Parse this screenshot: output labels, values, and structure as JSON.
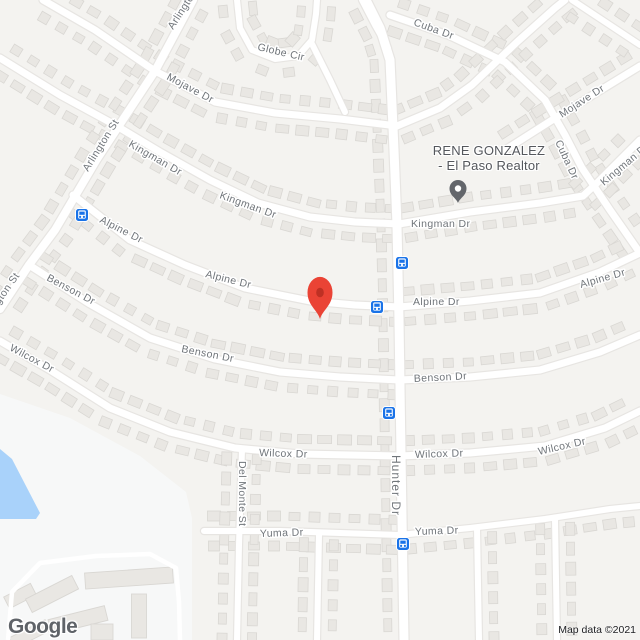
{
  "map": {
    "width": 640,
    "height": 640
  },
  "attribution": "Map data ©2021",
  "logo": "Google",
  "poi": {
    "line1": "RENE GONZALEZ",
    "line2": "- El Paso Realtor",
    "label_cx": 489,
    "pin": {
      "x": 458,
      "tip_y": 203
    }
  },
  "marker": {
    "x": 320,
    "tip_y": 319
  },
  "bus_stops": [
    {
      "x": 82,
      "y": 215
    },
    {
      "x": 402,
      "y": 263
    },
    {
      "x": 377,
      "y": 307
    },
    {
      "x": 389,
      "y": 413
    },
    {
      "x": 403,
      "y": 544
    }
  ],
  "labels": [
    {
      "t": "Arlington St",
      "x": 173,
      "y": 30,
      "r": -57
    },
    {
      "t": "Arlington St",
      "x": 88,
      "y": 172,
      "r": -58
    },
    {
      "t": "Arlington St",
      "x": -14,
      "y": 324,
      "r": -55
    },
    {
      "t": "Mojave Dr",
      "x": 166,
      "y": 79,
      "r": 28
    },
    {
      "t": "Globe Cir",
      "x": 257,
      "y": 50,
      "r": 13
    },
    {
      "t": "Kingman Dr",
      "x": 128,
      "y": 146,
      "r": 30
    },
    {
      "t": "Kingman Dr",
      "x": 219,
      "y": 198,
      "r": 20
    },
    {
      "t": "Alpine Dr",
      "x": 99,
      "y": 222,
      "r": 27
    },
    {
      "t": "Alpine Dr",
      "x": 205,
      "y": 277,
      "r": 14
    },
    {
      "t": "Benson Dr",
      "x": 46,
      "y": 280,
      "r": 28
    },
    {
      "t": "Benson Dr",
      "x": 181,
      "y": 352,
      "r": 11
    },
    {
      "t": "Wilcox Dr",
      "x": 9,
      "y": 350,
      "r": 28
    },
    {
      "t": "Wilcox Dr",
      "x": 259,
      "y": 456,
      "r": 2
    },
    {
      "t": "Cuba Dr",
      "x": 413,
      "y": 25,
      "r": 20
    },
    {
      "t": "Cuba Dr",
      "x": 555,
      "y": 142,
      "r": 65
    },
    {
      "t": "Mojave Dr",
      "x": 562,
      "y": 118,
      "r": -33
    },
    {
      "t": "Kingman Dr",
      "x": 604,
      "y": 186,
      "r": -40
    },
    {
      "t": "Kingman Dr",
      "x": 411,
      "y": 227,
      "r": 0
    },
    {
      "t": "Alpine Dr",
      "x": 413,
      "y": 305,
      "r": 0
    },
    {
      "t": "Alpine Dr",
      "x": 581,
      "y": 288,
      "r": -16
    },
    {
      "t": "Benson Dr",
      "x": 414,
      "y": 382,
      "r": -3
    },
    {
      "t": "Wilcox Dr",
      "x": 415,
      "y": 458,
      "r": -2
    },
    {
      "t": "Wilcox Dr",
      "x": 539,
      "y": 455,
      "r": -13
    },
    {
      "t": "Yuma Dr",
      "x": 260,
      "y": 537,
      "r": -2
    },
    {
      "t": "Yuma Dr",
      "x": 415,
      "y": 535,
      "r": -2
    },
    {
      "t": "Hunter Dr",
      "x": 392,
      "y": 455,
      "r": 90,
      "s": 12,
      "ls": 1
    },
    {
      "t": "Del Monte St",
      "x": 239,
      "y": 461,
      "r": 90
    }
  ],
  "roads": [
    {
      "name": "hunter-dr",
      "pts": [
        [
          366,
          0
        ],
        [
          380,
          28
        ],
        [
          390,
          60
        ],
        [
          394,
          150
        ],
        [
          397,
          225
        ],
        [
          399,
          320
        ],
        [
          401,
          455
        ],
        [
          404,
          640
        ]
      ],
      "w": 9,
      "houses": true
    },
    {
      "name": "cuba-dr",
      "pts": [
        [
          390,
          15
        ],
        [
          448,
          35
        ],
        [
          505,
          62
        ],
        [
          545,
          100
        ],
        [
          565,
          135
        ],
        [
          582,
          168
        ],
        [
          610,
          210
        ],
        [
          640,
          253
        ]
      ],
      "w": 7,
      "houses": true
    },
    {
      "name": "mojave-dr-w",
      "pts": [
        [
          43,
          0
        ],
        [
          95,
          30
        ],
        [
          155,
          71
        ],
        [
          215,
          102
        ],
        [
          275,
          113
        ],
        [
          340,
          119
        ],
        [
          397,
          126
        ],
        [
          440,
          108
        ],
        [
          472,
          85
        ],
        [
          517,
          42
        ],
        [
          555,
          8
        ],
        [
          565,
          0
        ]
      ],
      "w": 7,
      "houses": true
    },
    {
      "name": "mojave-dr-ne",
      "pts": [
        [
          505,
          150
        ],
        [
          560,
          115
        ],
        [
          640,
          66
        ]
      ],
      "w": 7,
      "houses": true
    },
    {
      "name": "kingman-dr-e",
      "pts": [
        [
          399,
          224
        ],
        [
          470,
          212
        ],
        [
          540,
          203
        ],
        [
          583,
          196
        ],
        [
          598,
          182
        ],
        [
          640,
          140
        ]
      ],
      "w": 7,
      "houses": true
    },
    {
      "name": "kingman-dr-w",
      "pts": [
        [
          0,
          58
        ],
        [
          60,
          95
        ],
        [
          115,
          125
        ],
        [
          160,
          152
        ],
        [
          210,
          180
        ],
        [
          258,
          203
        ],
        [
          310,
          217
        ],
        [
          355,
          222
        ],
        [
          399,
          224
        ]
      ],
      "w": 7,
      "houses": true
    },
    {
      "name": "arlington-st",
      "pts": [
        [
          193,
          0
        ],
        [
          155,
          71
        ],
        [
          124,
          118
        ],
        [
          97,
          159
        ],
        [
          55,
          230
        ],
        [
          29,
          265
        ],
        [
          0,
          309
        ]
      ],
      "w": 8,
      "houses": true
    },
    {
      "name": "alpine-dr-w",
      "pts": [
        [
          73,
          195
        ],
        [
          130,
          240
        ],
        [
          185,
          265
        ],
        [
          245,
          288
        ],
        [
          310,
          301
        ],
        [
          355,
          305
        ],
        [
          399,
          307
        ]
      ],
      "w": 7,
      "houses": true
    },
    {
      "name": "alpine-dr-e",
      "pts": [
        [
          399,
          307
        ],
        [
          470,
          301
        ],
        [
          540,
          293
        ],
        [
          600,
          272
        ],
        [
          640,
          253
        ]
      ],
      "w": 7,
      "houses": true
    },
    {
      "name": "benson-dr-w",
      "pts": [
        [
          29,
          265
        ],
        [
          90,
          304
        ],
        [
          150,
          338
        ],
        [
          215,
          359
        ],
        [
          280,
          372
        ],
        [
          340,
          377
        ],
        [
          399,
          380
        ]
      ],
      "w": 7,
      "houses": true
    },
    {
      "name": "benson-dr-e",
      "pts": [
        [
          399,
          380
        ],
        [
          470,
          377
        ],
        [
          540,
          370
        ],
        [
          600,
          352
        ],
        [
          640,
          335
        ]
      ],
      "w": 7,
      "houses": true
    },
    {
      "name": "wilcox-dr-w",
      "pts": [
        [
          0,
          341
        ],
        [
          50,
          370
        ],
        [
          110,
          408
        ],
        [
          170,
          432
        ],
        [
          235,
          448
        ],
        [
          300,
          454
        ],
        [
          399,
          456
        ]
      ],
      "w": 7,
      "houses": true
    },
    {
      "name": "wilcox-dr-e",
      "pts": [
        [
          399,
          456
        ],
        [
          470,
          453
        ],
        [
          545,
          446
        ],
        [
          605,
          428
        ],
        [
          640,
          411
        ]
      ],
      "w": 7,
      "houses": true
    },
    {
      "name": "yuma-dr-w",
      "pts": [
        [
          204,
          531
        ],
        [
          280,
          531
        ],
        [
          340,
          533
        ],
        [
          399,
          535
        ]
      ],
      "w": 6,
      "houses": true
    },
    {
      "name": "yuma-dr-e",
      "pts": [
        [
          399,
          535
        ],
        [
          470,
          528
        ],
        [
          545,
          519
        ],
        [
          610,
          509
        ],
        [
          640,
          506
        ]
      ],
      "w": 6,
      "houses": true
    },
    {
      "name": "del-monte-st",
      "pts": [
        [
          242,
          449
        ],
        [
          239,
          545
        ],
        [
          237,
          640
        ]
      ],
      "w": 6,
      "houses": true
    },
    {
      "name": "south-st-1",
      "pts": [
        [
          319,
          535
        ],
        [
          317,
          640
        ]
      ],
      "w": 6,
      "houses": true
    },
    {
      "name": "south-st-2",
      "pts": [
        [
          477,
          528
        ],
        [
          479,
          640
        ]
      ],
      "w": 6,
      "houses": true
    },
    {
      "name": "south-st-3",
      "pts": [
        [
          555,
          519
        ],
        [
          557,
          640
        ]
      ],
      "w": 6,
      "houses": true
    },
    {
      "name": "globe-cir",
      "pts": [
        [
          237,
          0
        ],
        [
          240,
          28
        ],
        [
          252,
          50
        ],
        [
          275,
          59
        ],
        [
          298,
          56
        ],
        [
          312,
          40
        ],
        [
          316,
          14
        ],
        [
          317,
          0
        ]
      ],
      "w": 6,
      "houses": true
    },
    {
      "name": "globe-conn",
      "pts": [
        [
          312,
          44
        ],
        [
          330,
          80
        ],
        [
          345,
          112
        ]
      ],
      "w": 6,
      "houses": false
    },
    {
      "name": "top-branch",
      "pts": [
        [
          362,
          0
        ],
        [
          375,
          25
        ],
        [
          388,
          48
        ]
      ],
      "w": 6,
      "houses": false
    },
    {
      "name": "ne-corner-st",
      "pts": [
        [
          572,
          0
        ],
        [
          640,
          45
        ]
      ],
      "w": 6,
      "houses": true
    }
  ],
  "water_poly": [
    [
      0,
      449
    ],
    [
      12,
      459
    ],
    [
      40,
      513
    ],
    [
      36,
      519
    ],
    [
      0,
      519
    ]
  ],
  "park_poly": [
    [
      0,
      394
    ],
    [
      70,
      418
    ],
    [
      140,
      456
    ],
    [
      186,
      492
    ],
    [
      192,
      518
    ],
    [
      192,
      640
    ],
    [
      0,
      640
    ]
  ],
  "lane_pts": [
    [
      8,
      640
    ],
    [
      12,
      592
    ],
    [
      40,
      563
    ],
    [
      96,
      556
    ],
    [
      150,
      554
    ],
    [
      176,
      568
    ],
    [
      179,
      602
    ],
    [
      180,
      640
    ]
  ],
  "apartments": [
    {
      "x": 20,
      "y": 596,
      "w": 30,
      "h": 13,
      "r": -27
    },
    {
      "x": 52,
      "y": 594,
      "w": 52,
      "h": 15,
      "r": -27
    },
    {
      "x": 129,
      "y": 578,
      "w": 88,
      "h": 16,
      "r": -4
    },
    {
      "x": 78,
      "y": 620,
      "w": 58,
      "h": 15,
      "r": -14
    },
    {
      "x": 102,
      "y": 632,
      "w": 22,
      "h": 16,
      "r": 0
    },
    {
      "x": 139,
      "y": 616,
      "w": 15,
      "h": 44,
      "r": 0
    },
    {
      "x": 30,
      "y": 634,
      "w": 40,
      "h": 12,
      "r": -27
    }
  ],
  "colors": {
    "land": "#f4f3f0",
    "road": "#ffffff",
    "casing": "#e7e5e2",
    "house": "#e9e7e3",
    "house_stroke": "#d9d7d3",
    "park": "#f7f8f8",
    "water": "#a9d2fa",
    "label": "#70757a",
    "poi_label": "#54575c",
    "marker": "#ea4335",
    "marker_inner": "#992015",
    "poi_pin": "#63666b",
    "transit": "#1a73e8",
    "attribution": "#202124",
    "logo": "#5f6368"
  }
}
